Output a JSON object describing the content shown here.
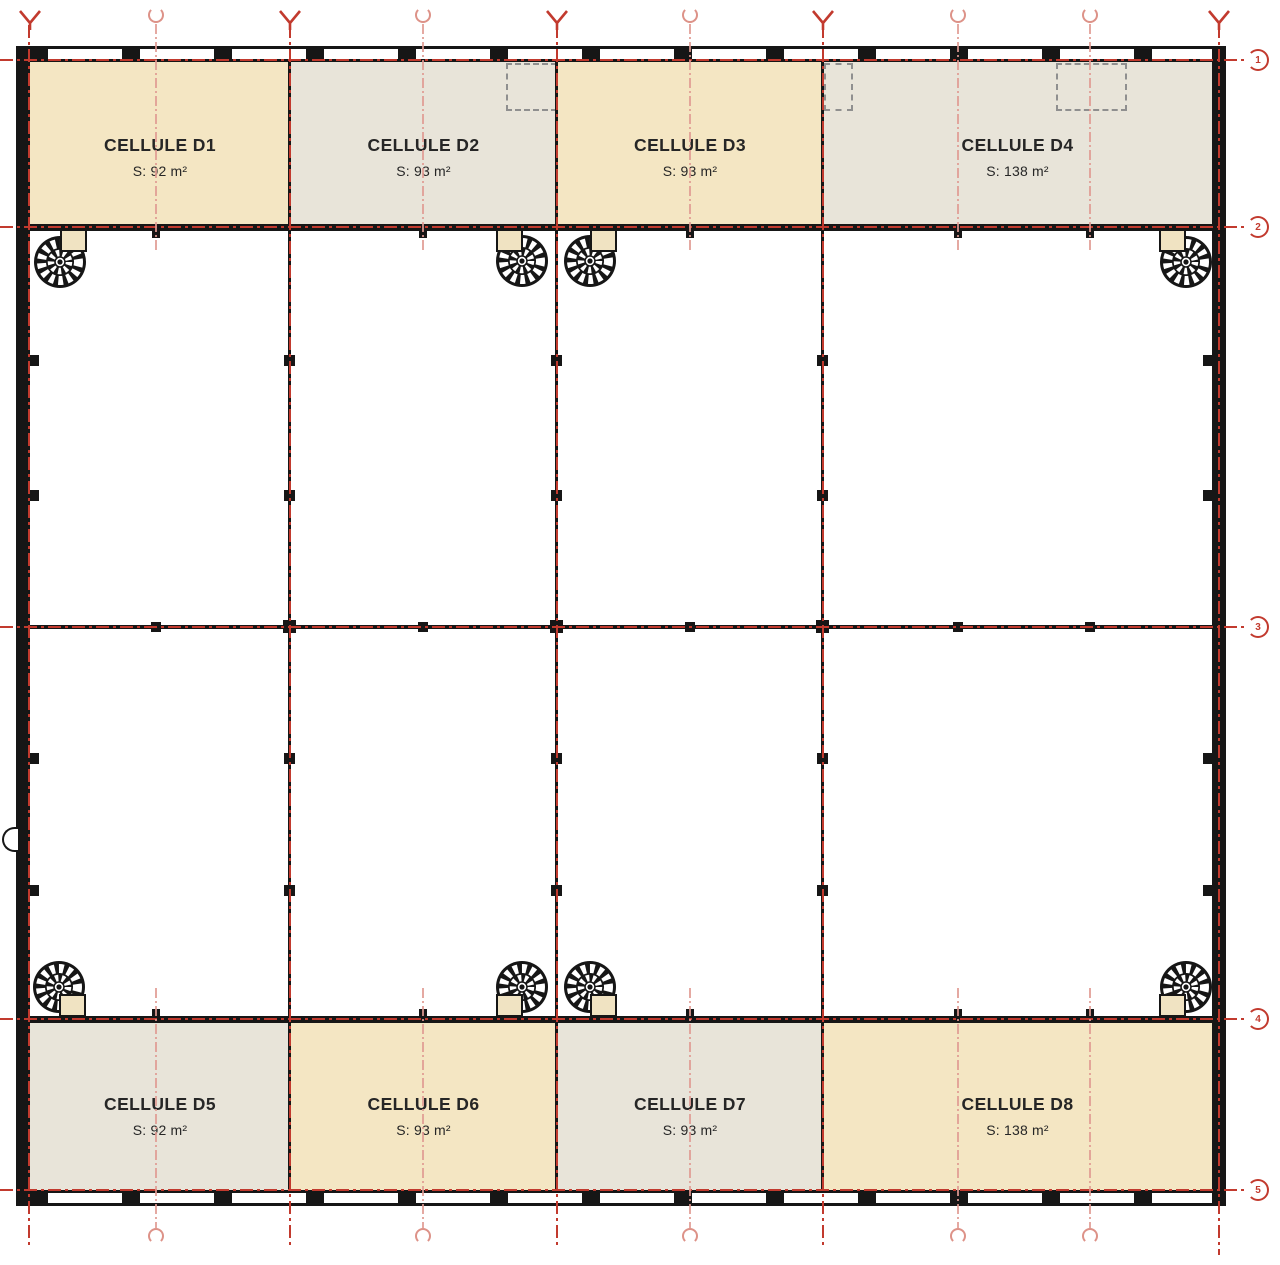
{
  "page": {
    "kind": "architectural floor plan drawing"
  },
  "plan": {
    "cells": [
      {
        "id": "D1",
        "name": "CELLULE D1",
        "area": "S: 92 m²",
        "fill": "#f4e6c3",
        "row": "top"
      },
      {
        "id": "D2",
        "name": "CELLULE D2",
        "area": "S: 93 m²",
        "fill": "#e8e4d9",
        "row": "top"
      },
      {
        "id": "D3",
        "name": "CELLULE D3",
        "area": "S: 93 m²",
        "fill": "#f4e6c3",
        "row": "top"
      },
      {
        "id": "D4",
        "name": "CELLULE D4",
        "area": "S: 138 m²",
        "fill": "#e8e4d9",
        "row": "top"
      },
      {
        "id": "D5",
        "name": "CELLULE D5",
        "area": "S: 92 m²",
        "fill": "#e8e4d9",
        "row": "bottom"
      },
      {
        "id": "D6",
        "name": "CELLULE D6",
        "area": "S: 93 m²",
        "fill": "#f4e6c3",
        "row": "bottom"
      },
      {
        "id": "D7",
        "name": "CELLULE D7",
        "area": "S: 93 m²",
        "fill": "#e8e4d9",
        "row": "bottom"
      },
      {
        "id": "D8",
        "name": "CELLULE D8",
        "area": "S: 138 m²",
        "fill": "#f4e6c3",
        "row": "bottom"
      }
    ],
    "grid": {
      "row_bubbles": [
        {
          "label": "1"
        },
        {
          "label": "2"
        },
        {
          "label": "3"
        },
        {
          "label": "4"
        },
        {
          "label": "5"
        }
      ]
    },
    "icons": {
      "spiral-stair-icon": "circular wheel of treads (plan symbol)",
      "axis-arrow-icon": "red Y survey arrow on column axes",
      "axis-circle-icon": "open pink circle on intermediate axes",
      "grid-bubble-icon": "red notched circle with row number",
      "door-icon": "half-round door on left wall"
    },
    "colors": {
      "wall": "#161616",
      "axis_red": "#c23a2e",
      "axis_pink": "#e09a92",
      "cell_beige": "#f4e6c3",
      "cell_gray": "#e8e4da",
      "opening_dash": "#8f8f8f",
      "background": "#ffffff"
    }
  }
}
